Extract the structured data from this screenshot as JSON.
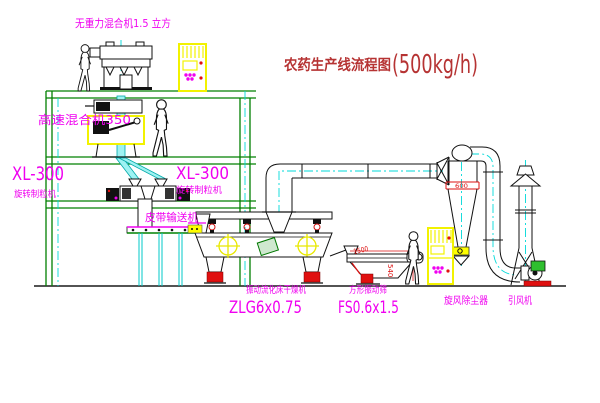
{
  "diagram": {
    "title": {
      "text": "农药生产线流程图",
      "capacity": "(500kg/h)"
    },
    "equipment": {
      "top_mixer_label": "无重力混合机1.5 立方",
      "high_speed_mixer_label": "高速混合机350",
      "granulator_left_model": "XL-300",
      "granulator_left_name": "旋转制粒机",
      "granulator_right_model": "XL-300",
      "granulator_right_name": "旋转制粒机",
      "belt_conveyor_label": "皮带输送机",
      "dryer_name": "振动流化床干燥机",
      "dryer_model": "ZLG6x0.75",
      "sieve_name": "方形振动筛",
      "sieve_model": "FS0.6x1.5",
      "cyclone_label": "旋风除尘器",
      "fan_label": "引风机"
    },
    "dimensions": {
      "cyclone_band": "600",
      "sieve_width": "1500",
      "sieve_height": "540"
    },
    "colors": {
      "label_magenta": "#f000f0",
      "title_red": "#b63333",
      "dimension_red": "#dd1111",
      "structure_green": "#008000",
      "centerline_cyan": "#00d9d9",
      "highlight_yellow": "#ffff00"
    }
  }
}
